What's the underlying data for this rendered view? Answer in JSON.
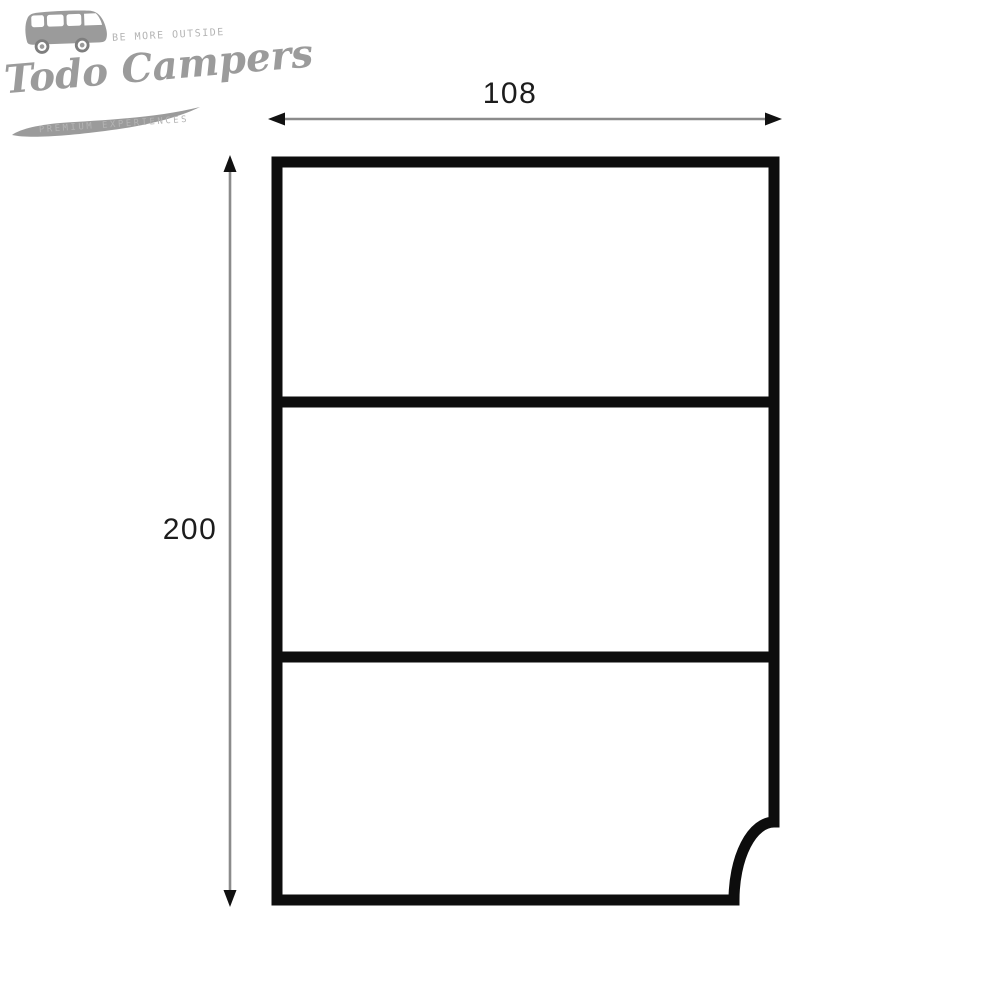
{
  "logo": {
    "tagline_top": "BE MORE OUTSIDE",
    "brand_name": "Todo Campers",
    "tagline_bottom": "PREMIUM EXPERIENCES",
    "brand_color": "#9b9b9b",
    "tagline_color": "#b4b4b4"
  },
  "diagram": {
    "width_cm": "108",
    "height_cm": "200",
    "panel_count": 3,
    "notch": "bottom-right concave quarter-round cutout",
    "outline_color": "#0d0d0d",
    "dimension_line_color": "#8b8b8b",
    "label_color": "#1c1c1c"
  }
}
